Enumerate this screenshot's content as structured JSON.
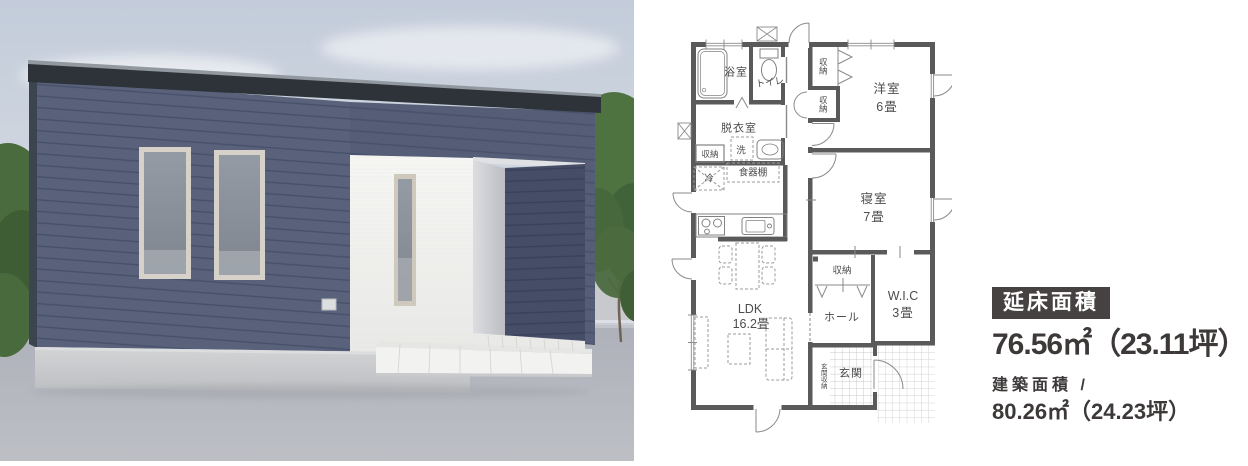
{
  "photo": {
    "description": "exterior render of flat-roof single-story house",
    "colors": {
      "sky": "#c6cedb",
      "siding": "#59627a",
      "siding_shadow": "#454e66",
      "roof_fascia": "#2e3339",
      "accent_wall": "#f5f5f3",
      "foundation": "#c9cacc",
      "ground": "#b4b7bf",
      "foliage": "#4d7040"
    }
  },
  "floorplan": {
    "wall_color": "#5a5a5a",
    "labels": {
      "bath": "浴室",
      "toilet": "トイレ",
      "dressing_room": "脱衣室",
      "washer": "洗",
      "dressing_storage": "収納",
      "fridge": "冷",
      "cupboard": "食器棚",
      "storage_a": "収納",
      "storage_b": "収納",
      "western_room_name": "洋室",
      "western_room_size": "6畳",
      "bedroom_name": "寝室",
      "bedroom_size": "7畳",
      "hall_storage": "収納",
      "hall": "ホール",
      "wic_name": "W.I.C",
      "wic_size": "3畳",
      "ldk_name": "LDK",
      "ldk_size": "16.2畳",
      "entry_storage": "玄関収納",
      "entry": "玄関"
    }
  },
  "info": {
    "badge": "延床面積",
    "total_area": "76.56㎡（23.11坪）",
    "building_area_label": "建築面積 /",
    "building_area": "80.26㎡（24.23坪）",
    "text_color": "#3d3939",
    "badge_bg": "#474242"
  }
}
